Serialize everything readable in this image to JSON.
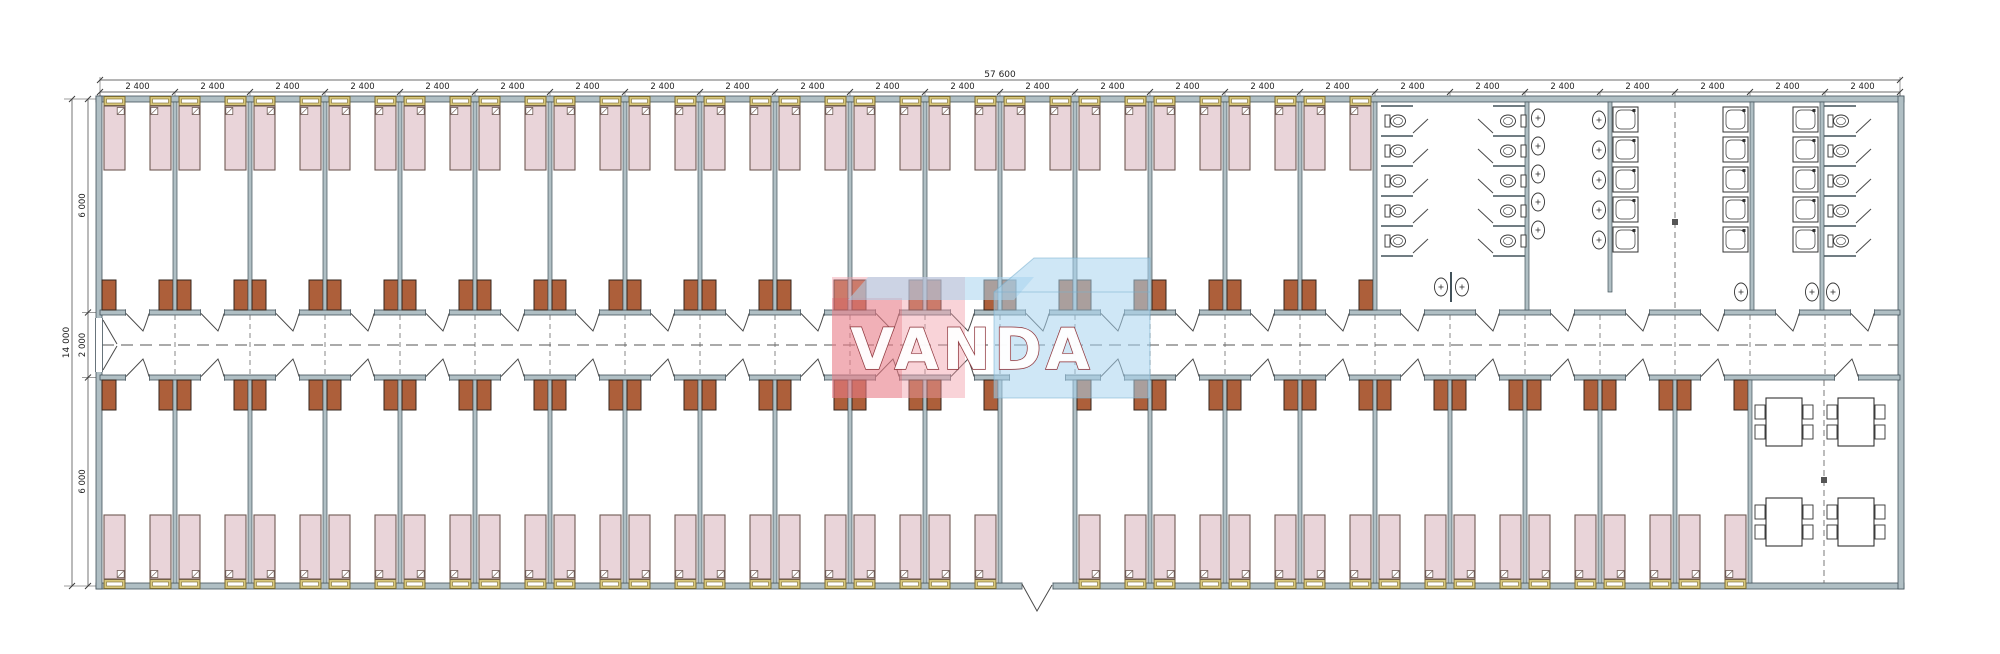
{
  "drawing": {
    "type": "dormitory-building-floor-plan",
    "dimensions": {
      "top": {
        "overall_label": "57 600",
        "bay_label": "2 400",
        "bay_count": 24
      },
      "left": {
        "overall_label": "14 000",
        "segment_labels": [
          "6 000",
          "2 000",
          "6 000"
        ]
      }
    },
    "building": {
      "top_bedroom_count": 17,
      "bottom_bedroom_count_left": 12,
      "bottom_bedroom_count_right": 9,
      "beds_per_room": 2,
      "wardrobes_per_room": 2,
      "entrance_lobby_bay": 13,
      "dining_room": {
        "tables": 4,
        "chairs_per_table": 4
      },
      "sanitary": {
        "wc_stalls_per_column": 5,
        "wc_stall_columns": 3,
        "showers_per_column": 5,
        "shower_columns": 3,
        "washbasins_per_column": 5,
        "washbasin_columns": 2,
        "bottom_washbasins": 5
      }
    },
    "colors": {
      "wall_fill": "#b0bfc4",
      "wall_stroke": "#42525a",
      "bed_fill": "#e9d4d9",
      "bed_stroke": "#6f5a54",
      "window_fill": "#d9c87b",
      "window_stroke": "#7a6a30",
      "cabinet_fill": "#ad5f3a",
      "cabinet_stroke": "#33261d",
      "line": "#3a3a3a",
      "dash": "#6a6a6a",
      "fixture_stroke": "#333333",
      "dim_text": "#222222"
    },
    "watermark": {
      "text": "VANDA",
      "pink": "rgba(242,158,168,0.45)",
      "red": "rgba(222,85,98,0.28)",
      "blue": "rgba(168,212,238,0.55)",
      "blue_edge": "rgba(120,175,205,0.55)",
      "text_fill": "#ffffff",
      "text_outline": "#8b2f36"
    }
  }
}
